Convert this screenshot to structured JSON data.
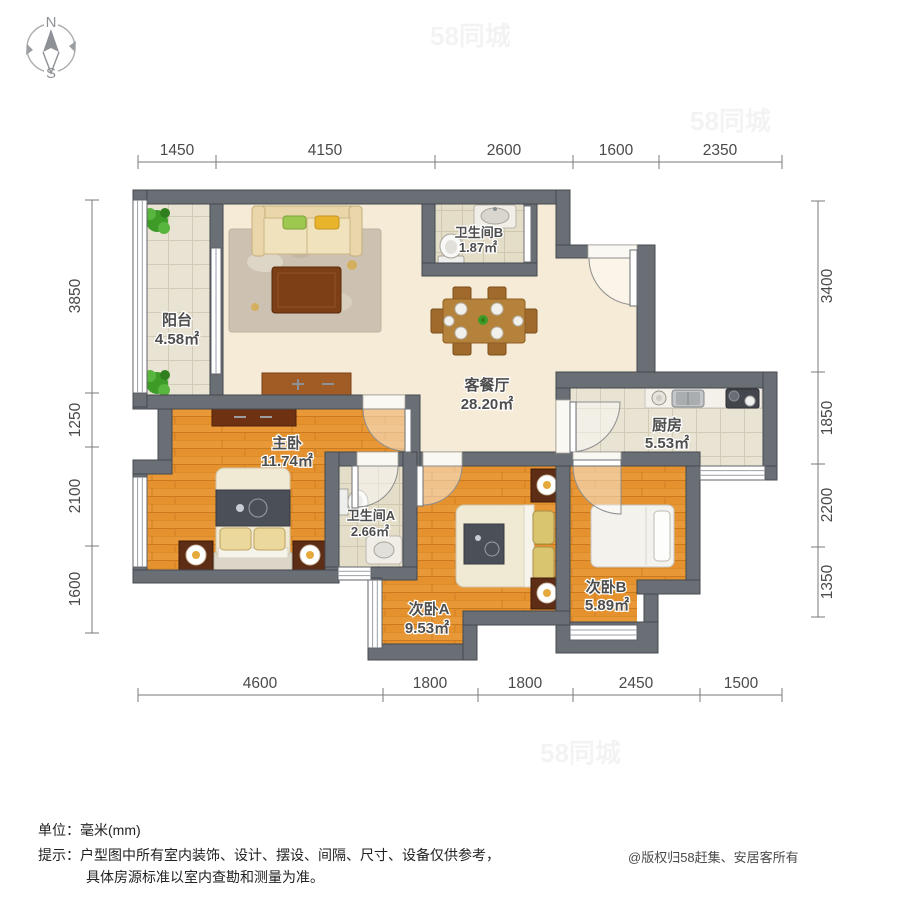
{
  "compass": {
    "north": "N",
    "south": "S"
  },
  "watermark": "58同城",
  "rooms": [
    {
      "id": "balcony",
      "name": "阳台",
      "area": "4.58㎡"
    },
    {
      "id": "bathroom_b",
      "name": "卫生间B",
      "area": "1.87㎡"
    },
    {
      "id": "living_dining",
      "name": "客餐厅",
      "area": "28.20㎡"
    },
    {
      "id": "kitchen",
      "name": "厨房",
      "area": "5.53㎡"
    },
    {
      "id": "master_bedroom",
      "name": "主卧",
      "area": "11.74㎡"
    },
    {
      "id": "bathroom_a",
      "name": "卫生间A",
      "area": "2.66㎡"
    },
    {
      "id": "bedroom_a",
      "name": "次卧A",
      "area": "9.53㎡"
    },
    {
      "id": "bedroom_b",
      "name": "次卧B",
      "area": "5.89㎡"
    }
  ],
  "dimensions": {
    "top": [
      "1450",
      "4150",
      "2600",
      "1600",
      "2350"
    ],
    "bottom": [
      "4600",
      "1800",
      "1800",
      "2450",
      "1500"
    ],
    "left": [
      "3850",
      "1250",
      "2100",
      "1600"
    ],
    "right": [
      "3400",
      "1850",
      "2200",
      "1350"
    ]
  },
  "notes": {
    "unit_label": "单位：毫米(mm)",
    "tip_line1": "提示：户型图中所有室内装饰、设计、摆设、间隔、尺寸、设备仅供参考，",
    "tip_line2": "具体房源标准以室内查勘和测量为准。"
  },
  "copyright": "@版权归58赶集、安居客所有",
  "colors": {
    "wall": "#6a6e75",
    "wood_floor": "#e5922e",
    "tile_floor": "#e8e3d2",
    "living_floor": "#f6ebd7",
    "label_text": "#4d4d4d"
  }
}
